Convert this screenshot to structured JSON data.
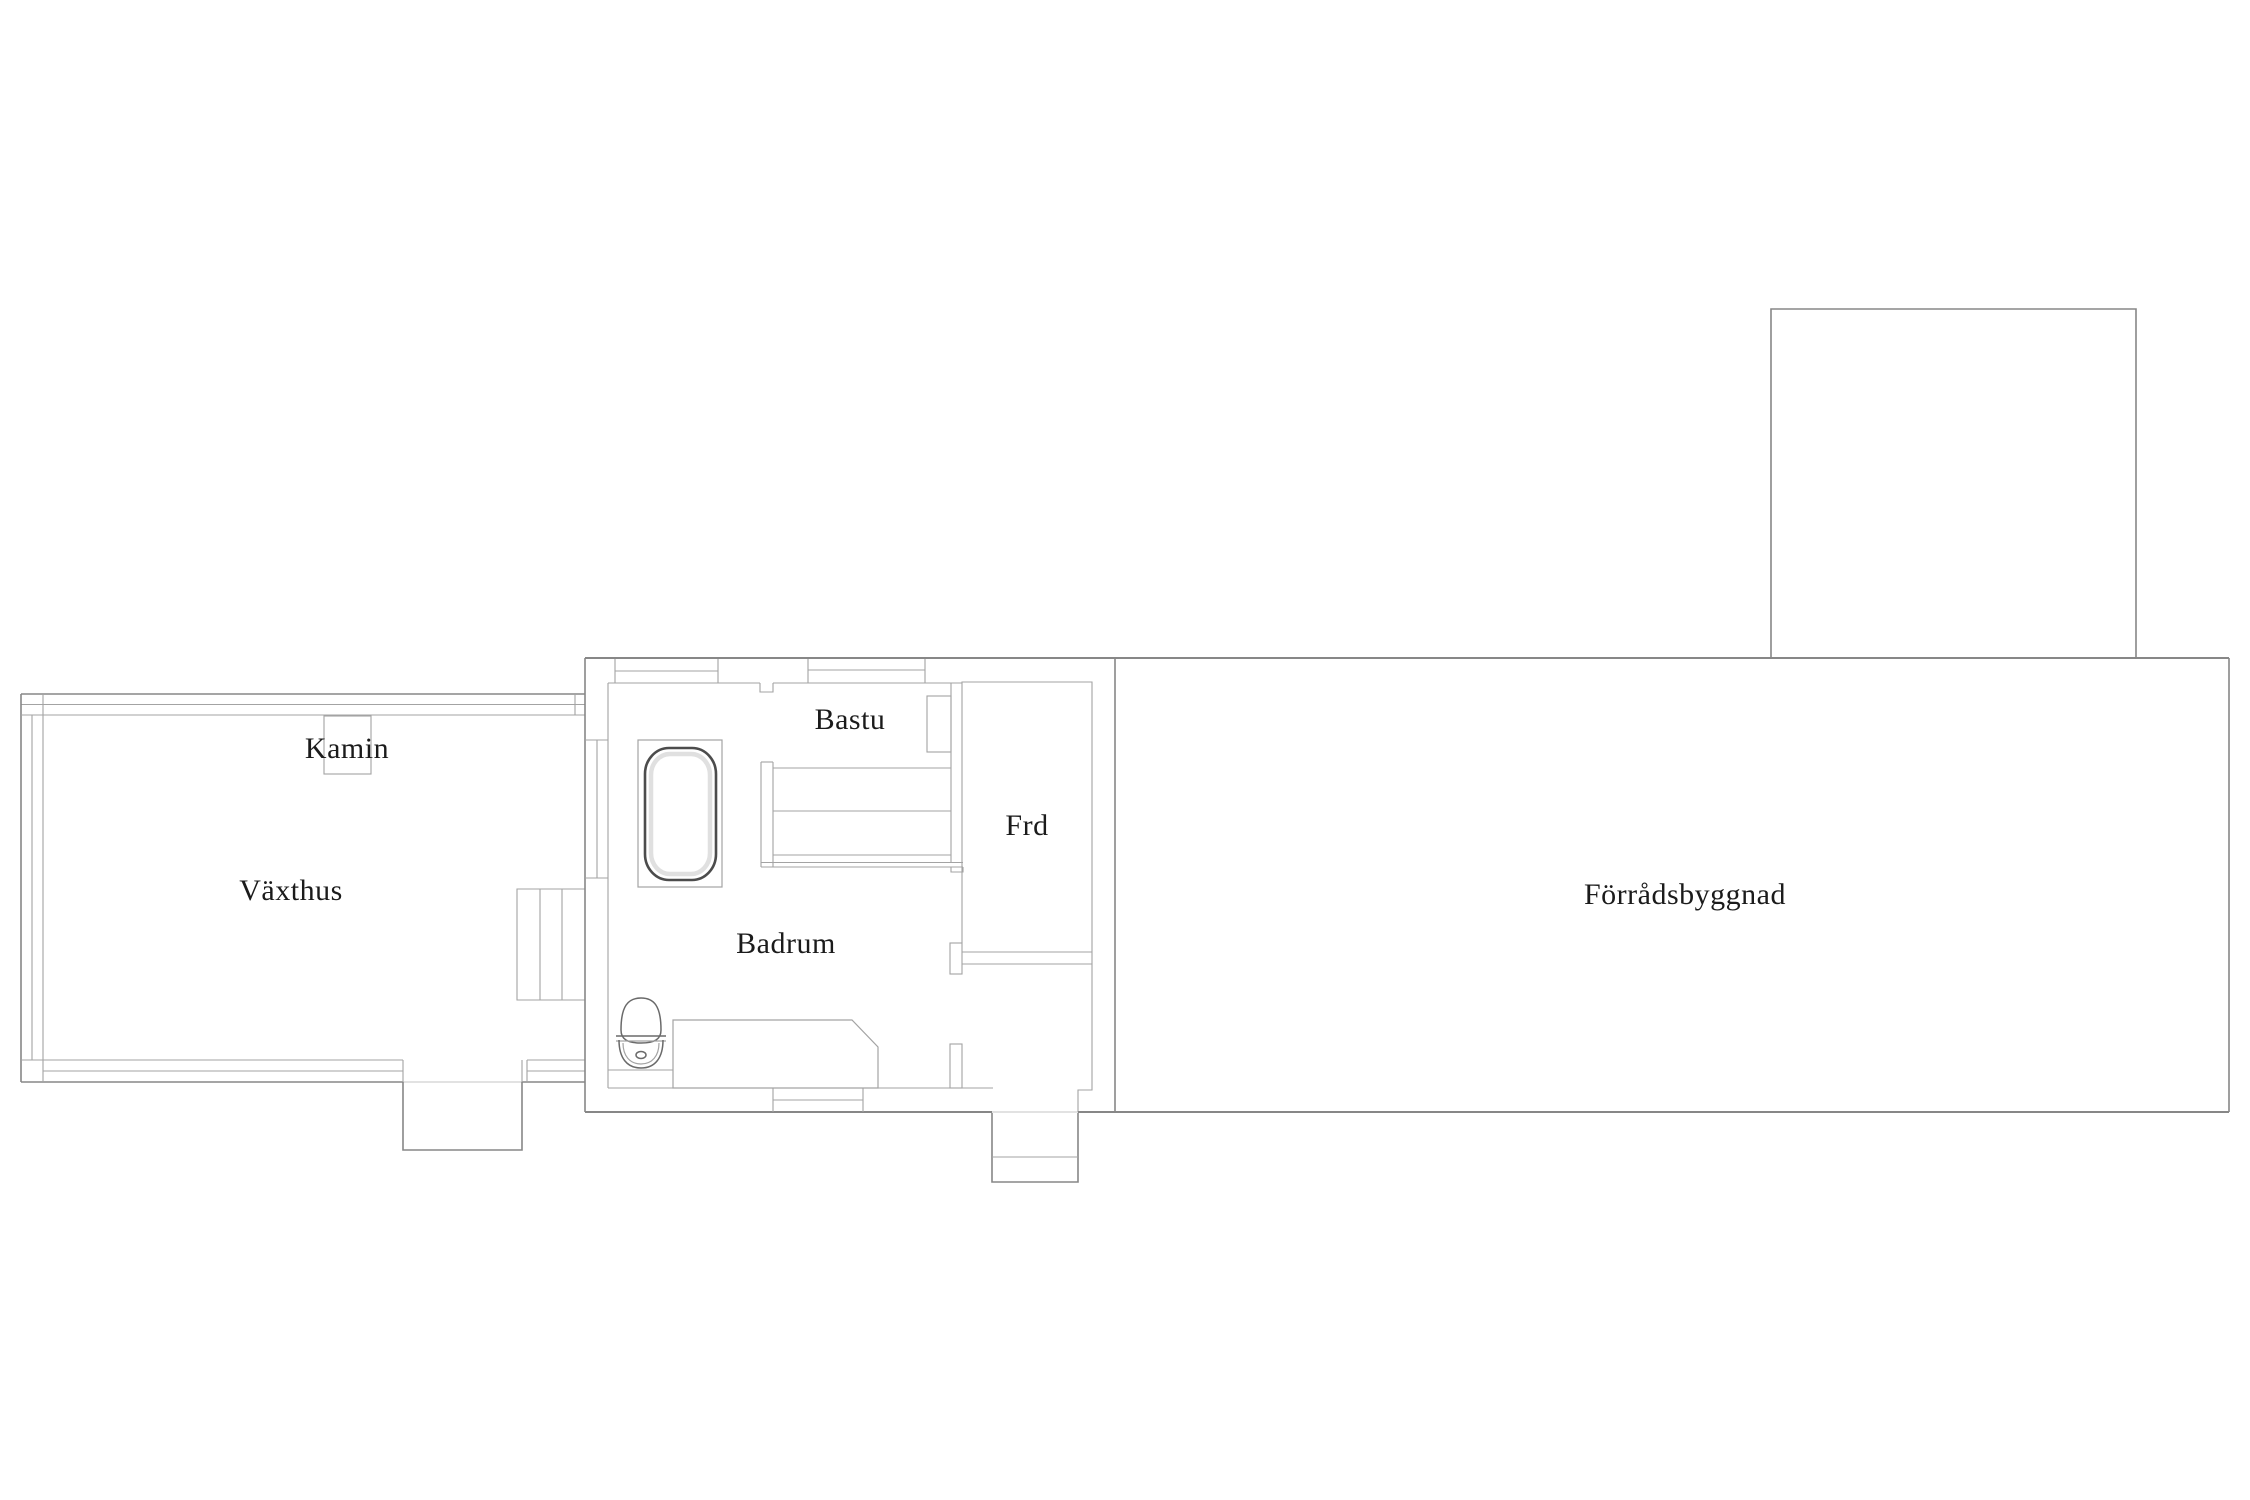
{
  "floorplan": {
    "labels": {
      "vaxthus": "Växthus",
      "kamin": "Kamin",
      "bastu": "Bastu",
      "frd": "Frd",
      "badrum": "Badrum",
      "forradsbyggnad": "Förrådsbyggnad"
    },
    "colors": {
      "background": "#ffffff",
      "wall_line": "#878787",
      "thin_line": "#a3a3a3",
      "threshold_line": "#c4c4c4",
      "fixture_mid_line": "#6a6a6a",
      "fixture_dark_line": "#4c4c4c",
      "fixture_highlight": "#e0e0e0",
      "text": "#1b1b1b"
    },
    "fixtures": [
      "fireplace",
      "bathtub",
      "toilet",
      "counter",
      "sauna-benches",
      "sauna-heater",
      "stairs",
      "entry-steps",
      "greenhouse-step"
    ]
  }
}
